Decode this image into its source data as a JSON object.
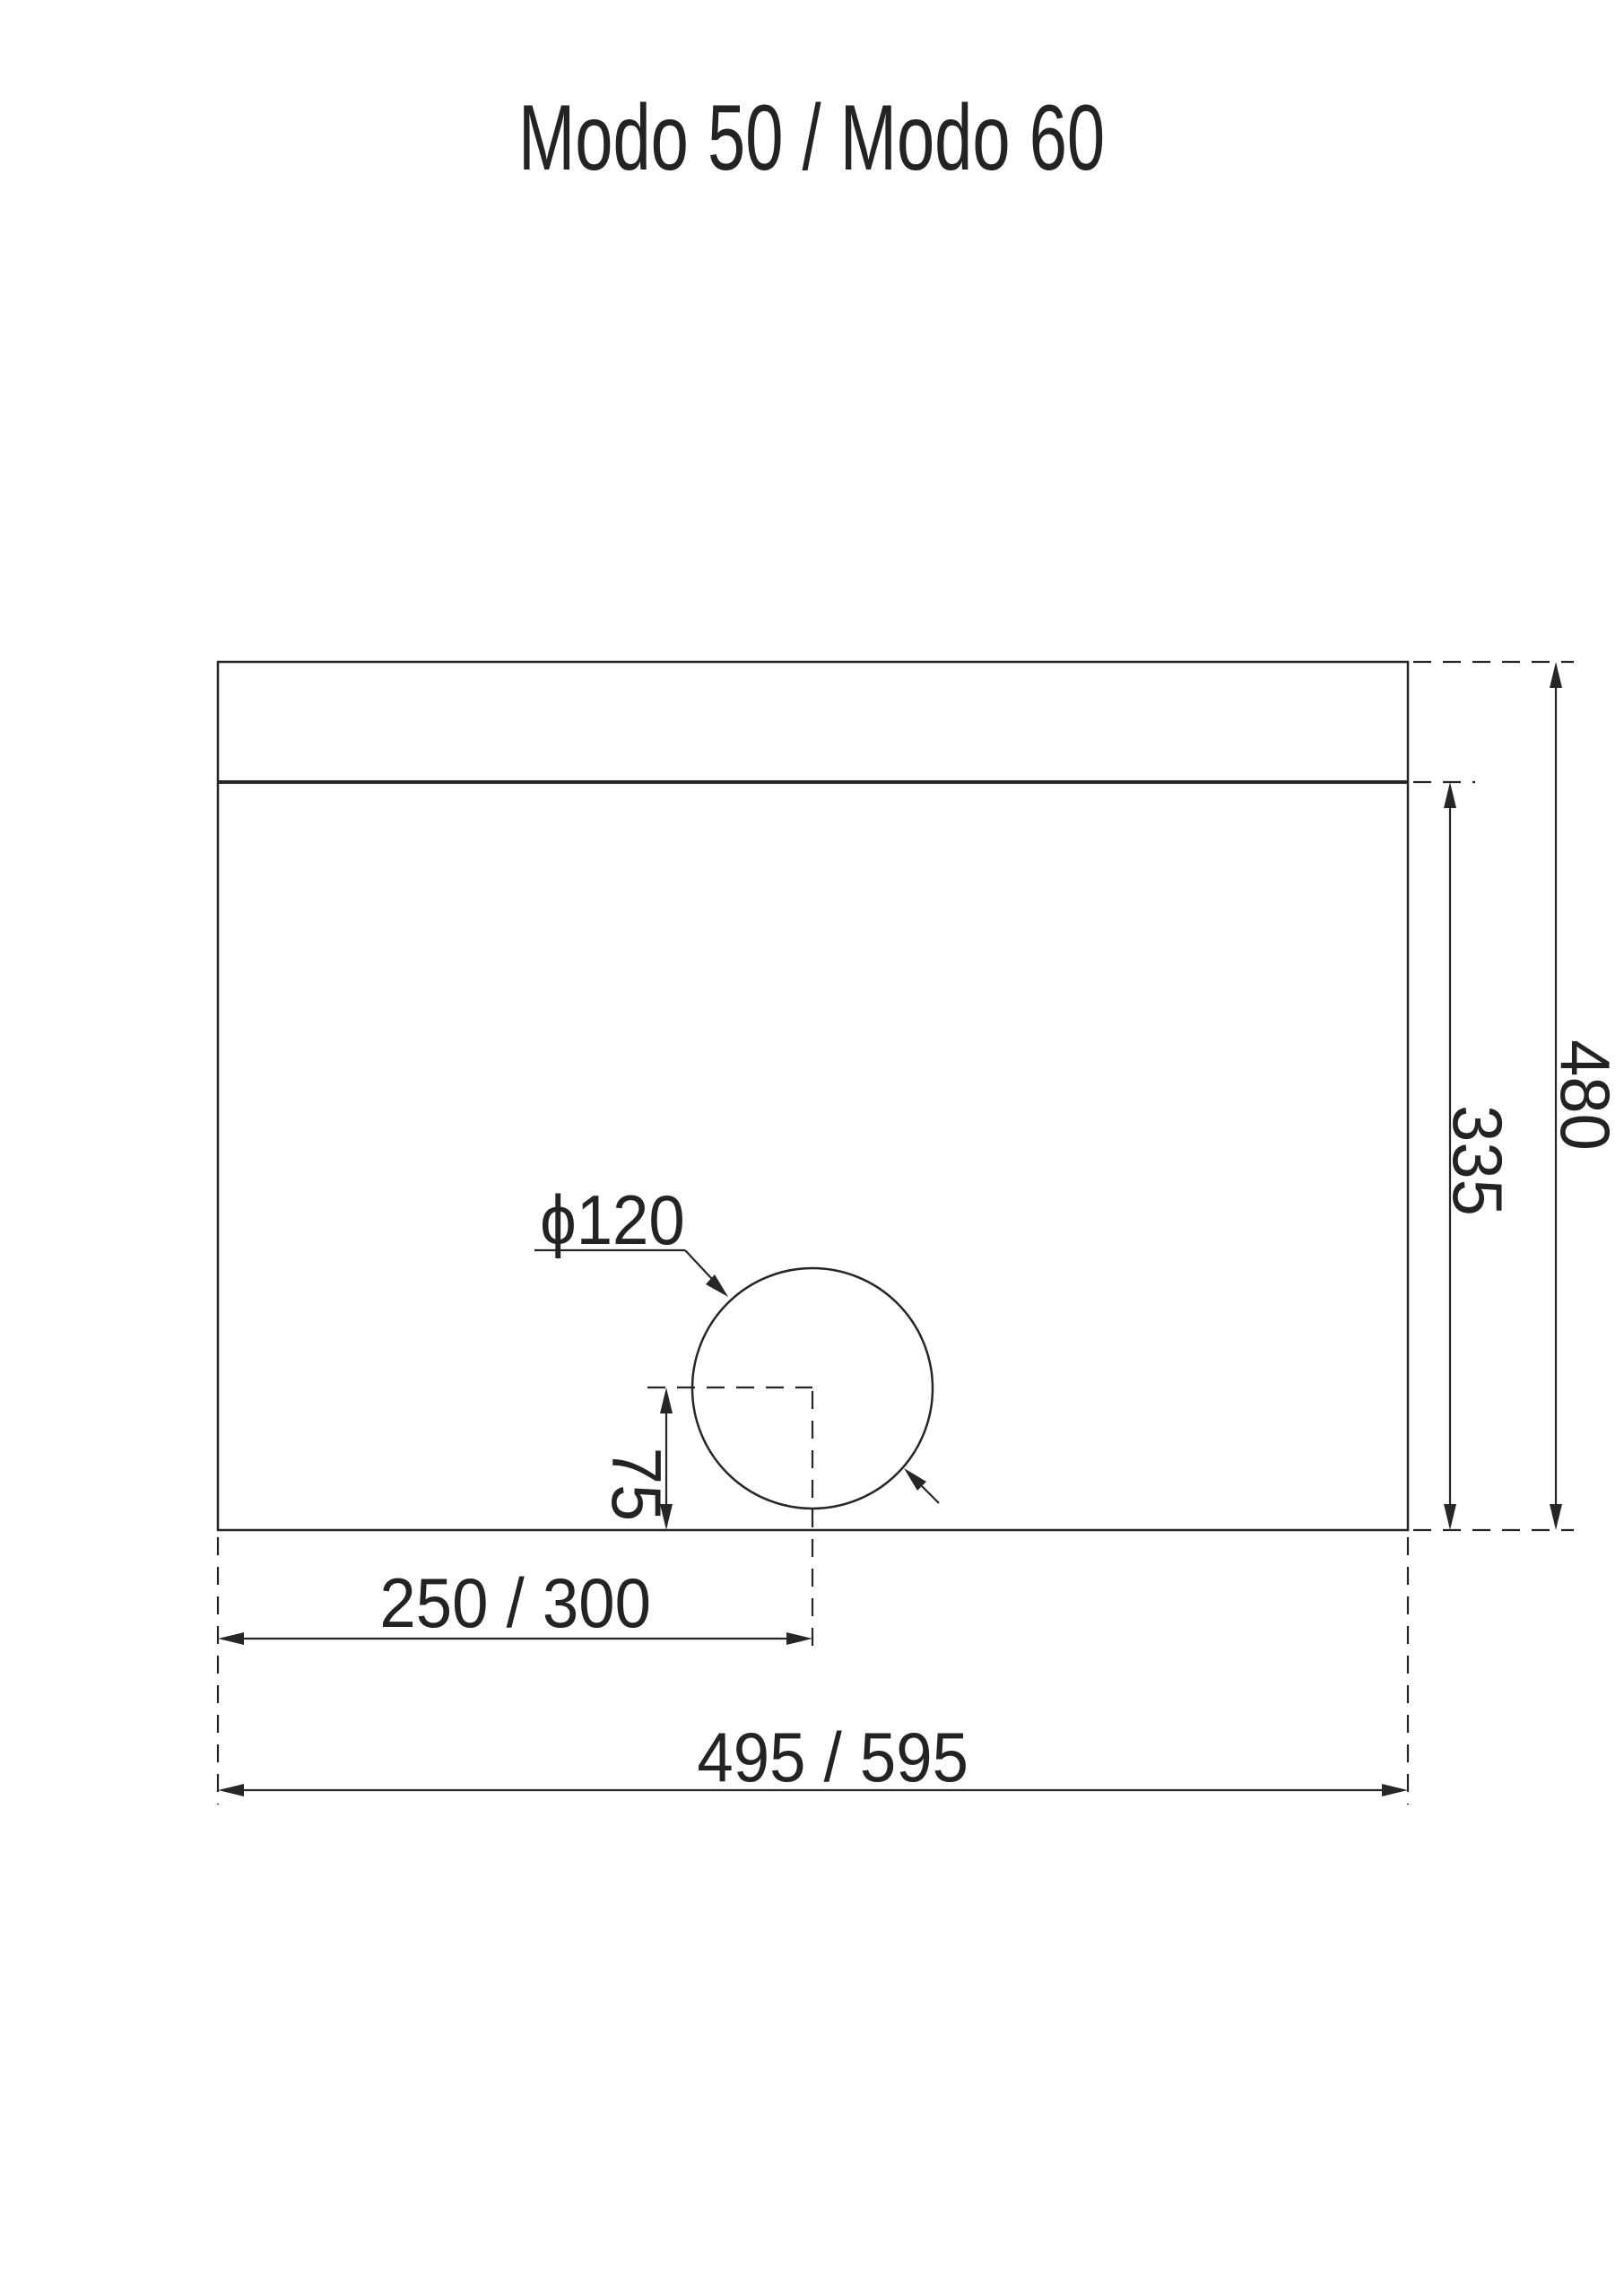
{
  "page": {
    "background_color": "#ffffff",
    "line_color": "#262626"
  },
  "title": "Modo 50 / Modo 60",
  "drawing": {
    "type": "technical-dimension-drawing",
    "cutout_diameter_label": "ϕ120",
    "dimensions": {
      "total_height": "480",
      "inner_height": "335",
      "circle_offset_from_bottom": "75",
      "circle_center_from_left": "250 / 300",
      "total_width": "495 / 595"
    }
  }
}
